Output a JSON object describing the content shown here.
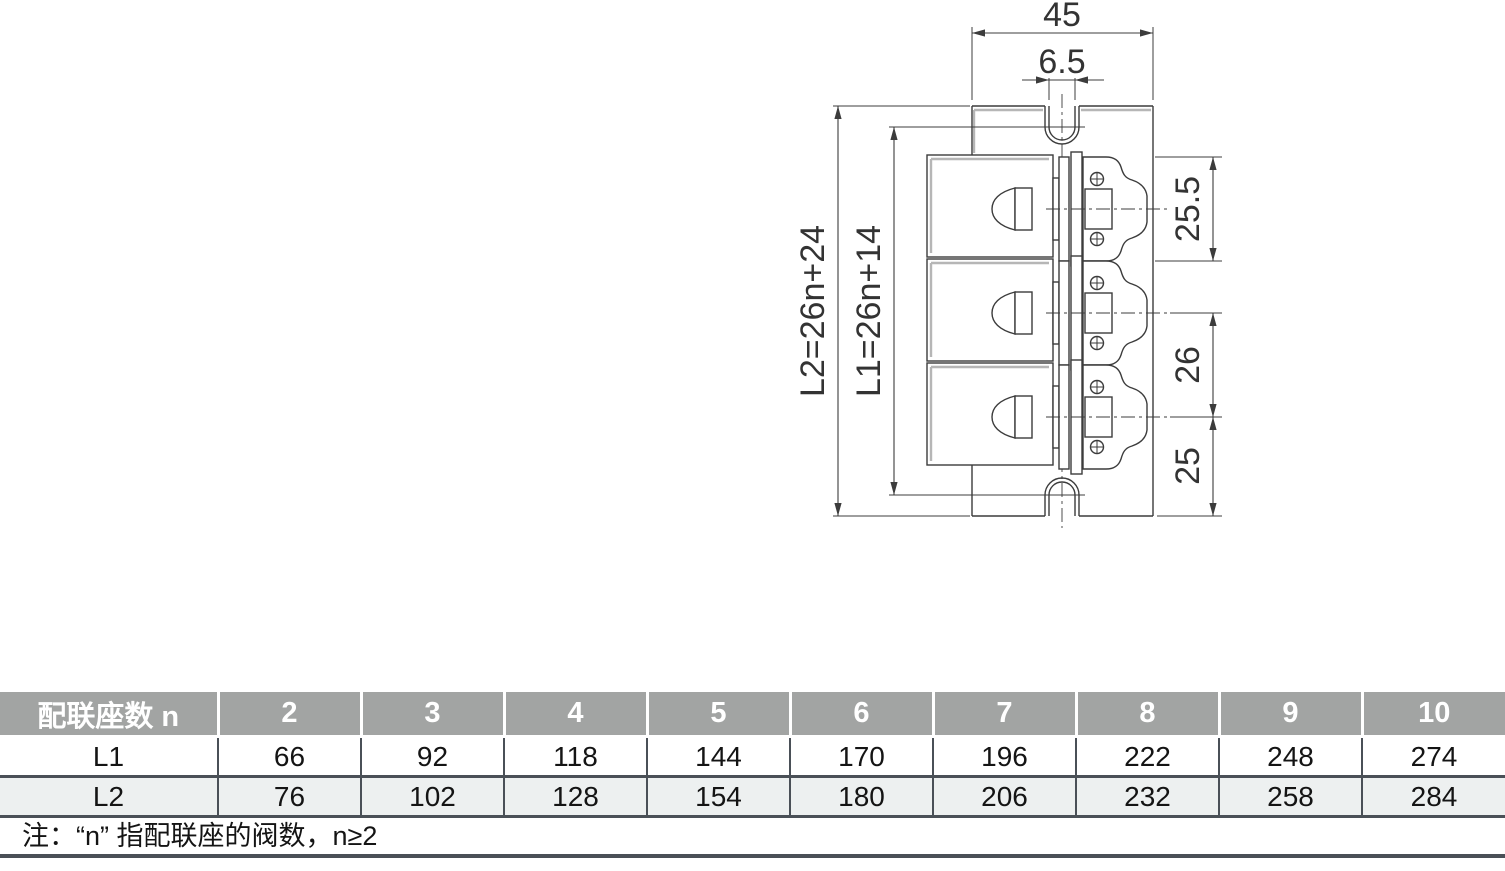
{
  "drawing": {
    "dimensions": {
      "width": "45",
      "slot_width": "6.5",
      "l2_formula": "L2=26n+24",
      "l1_formula": "L1=26n+14",
      "pitch_top": "25.5",
      "pitch_mid": "26",
      "pitch_bottom": "25"
    }
  },
  "table": {
    "header_label": "配联座数 n",
    "columns": [
      "2",
      "3",
      "4",
      "5",
      "6",
      "7",
      "8",
      "9",
      "10"
    ],
    "rows": [
      {
        "label": "L1",
        "values": [
          "66",
          "92",
          "118",
          "144",
          "170",
          "196",
          "222",
          "248",
          "274"
        ]
      },
      {
        "label": "L2",
        "values": [
          "76",
          "102",
          "128",
          "154",
          "180",
          "206",
          "232",
          "258",
          "284"
        ]
      }
    ],
    "note": "注：“n” 指配联座的阀数，n≥2"
  },
  "colors": {
    "table_header_bg": "#a2a4a3",
    "table_alt_row_bg": "#edf0f0",
    "table_border": "#4a5057",
    "drawing_line": "#3c3c3c",
    "dim_text": "#333333"
  }
}
